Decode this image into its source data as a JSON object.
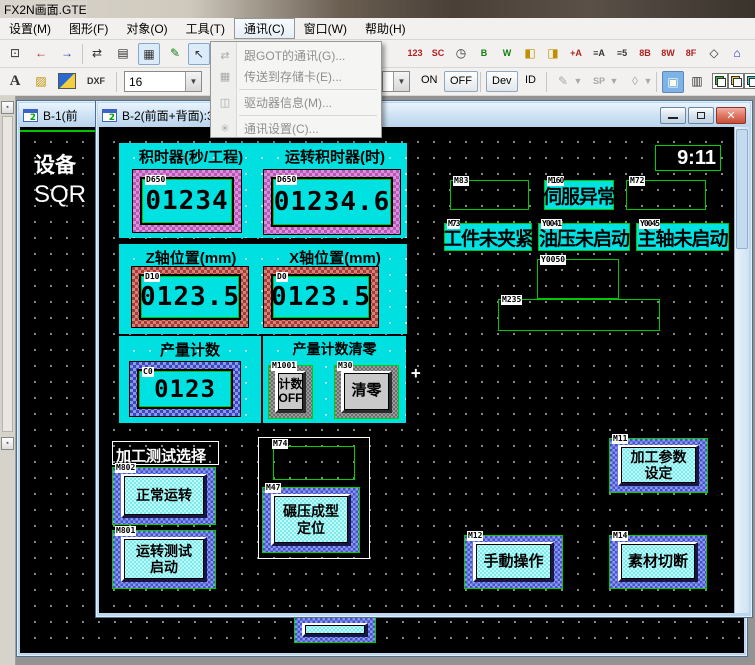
{
  "titlebar": {
    "title": "FX2N画面.GTE"
  },
  "menubar": {
    "items": [
      "设置(M)",
      "图形(F)",
      "对象(O)",
      "工具(T)",
      "通讯(C)",
      "窗口(W)",
      "帮助(H)"
    ]
  },
  "comm_menu": {
    "items": [
      {
        "icon": "⇄",
        "label": "跟GOT的通讯(G)..."
      },
      {
        "icon": "▦",
        "label": "传送到存储卡(E)..."
      },
      {
        "icon": "◫",
        "label": "驱动器信息(M)..."
      },
      {
        "icon": "✳",
        "label": "通讯设置(C)..."
      }
    ]
  },
  "toolbar_row1": {
    "icons": [
      "⊡",
      "←",
      "→",
      "⇄",
      "▤",
      "▦",
      "✎",
      "↖"
    ],
    "right_icons": [
      "123",
      "SC",
      "◷",
      "B",
      "W",
      "◧",
      "◨",
      "+A",
      "≡A",
      "≡5",
      "8B",
      "8W",
      "8F",
      "◇",
      "⌂"
    ]
  },
  "toolbar_row2": {
    "text_tool": "A",
    "paint_tool": "▨",
    "dxf": "DXF",
    "font_size": "16",
    "caret": "▼",
    "on": "ON",
    "off": "OFF",
    "dev": "Dev",
    "id": "ID",
    "pen": "✎",
    "sp": "SP",
    "fill": "◊"
  },
  "mdi": {
    "icon_badge": "2"
  },
  "windows": {
    "b1": {
      "title": "B-1(前",
      "bg_text_line1": "设备",
      "bg_text_line2": "SQR"
    },
    "b2": {
      "title": "B-2(前面+背面):3"
    }
  },
  "screen": {
    "clock": "9:11",
    "cursor": "+",
    "timer_panel": {
      "label_left": "积时器(秒/工程)",
      "label_right": "运转积时器(时)",
      "display_left": {
        "device": "D650",
        "value": "01234"
      },
      "display_right": {
        "device": "D650",
        "value": "01234.6"
      }
    },
    "axis_panel": {
      "label_left": "Z轴位置(mm)",
      "label_right": "X轴位置(mm)",
      "display_left": {
        "device": "D10",
        "value": "0123.5"
      },
      "display_right": {
        "device": "D0",
        "value": "0123.5"
      }
    },
    "counter_panel": {
      "label": "产量计数",
      "display": {
        "device": "C0",
        "value": "0123"
      }
    },
    "counter_reset_panel": {
      "label": "产量计数清零",
      "toggle_button": {
        "device": "M1001",
        "line1": "计数",
        "line2": "OFF"
      },
      "clear_button": {
        "device": "M30",
        "line1": "清零"
      }
    },
    "test_select": {
      "label": "加工测试选择",
      "normal_button": {
        "device": "M802",
        "line1": "正常运转"
      },
      "test_button": {
        "device": "M801",
        "line1": "运转测试",
        "line2": "启动"
      }
    },
    "m74_group": {
      "device": "M74",
      "press_button": {
        "device": "M47",
        "line1": "碾压成型",
        "line2": "定位"
      }
    },
    "alarms": {
      "m83": {
        "device": "M83"
      },
      "m160": {
        "device": "M160",
        "text": "伺服异常"
      },
      "m72": {
        "device": "M72"
      },
      "m73": {
        "device": "M73",
        "text": "工件未夹紧"
      },
      "y0041": {
        "device": "Y0041",
        "text": "油压未启动"
      },
      "y0045": {
        "device": "Y0045",
        "text": "主轴未启动"
      },
      "y0050": {
        "device": "Y0050"
      },
      "m235": {
        "device": "M235"
      }
    },
    "nav_buttons": {
      "params": {
        "device": "M11",
        "line1": "加工参数",
        "line2": "设定"
      },
      "manual": {
        "device": "M12",
        "line1": "手動操作"
      },
      "cut": {
        "device": "M14",
        "line1": "素材切断"
      }
    }
  }
}
